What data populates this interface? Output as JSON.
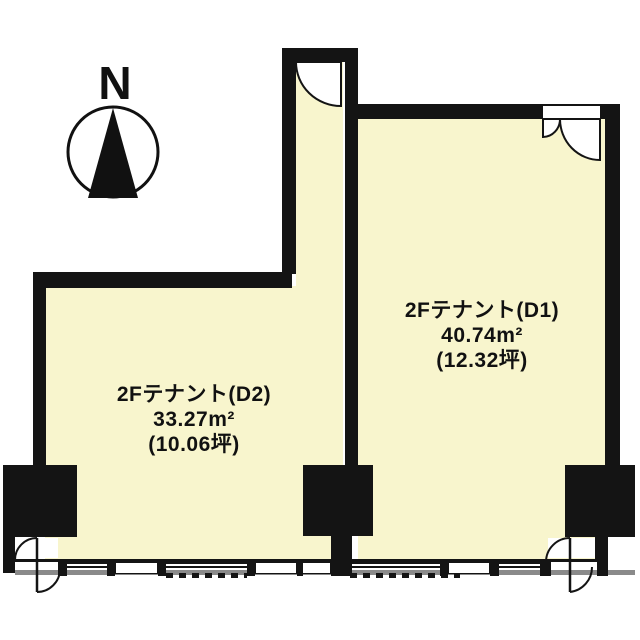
{
  "title": "2F floor plan",
  "compass": {
    "north_label": "N"
  },
  "rooms": {
    "d1": {
      "name": "2Fテナント(D1)",
      "area_m2": "40.74m²",
      "area_tsubo": "(12.32坪)"
    },
    "d2": {
      "name": "2Fテナント(D2)",
      "area_m2": "33.27m²",
      "area_tsubo": "(10.06坪)"
    }
  },
  "colors": {
    "wall": "#141414",
    "floor": "#f8f5cd",
    "gray": "#8a8a8a",
    "bg": "#ffffff"
  }
}
